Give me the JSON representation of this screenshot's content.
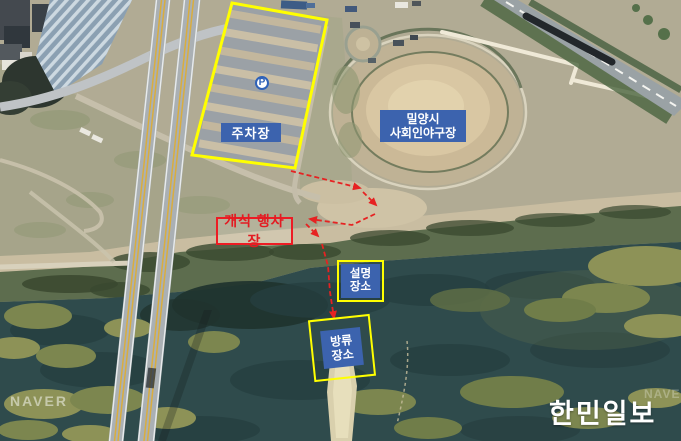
{
  "annotations": {
    "parking": {
      "label": "주차장",
      "icon": "P"
    },
    "stadium": {
      "line1": "밀양시",
      "line2": "사회인야구장"
    },
    "ceremony": {
      "label": "개식 행사장"
    },
    "briefing": {
      "line1": "설명",
      "line2": "장소"
    },
    "release": {
      "line1": "방류",
      "line2": "장소"
    }
  },
  "watermarks": {
    "provider": "NAVER",
    "provider_partial": "NAVER",
    "press": "한민일보"
  },
  "colors": {
    "highlight_yellow": "#ffff00",
    "label_blue": "#3c63ae",
    "alert_red": "#ed1c24",
    "arrow_red": "#e62222"
  }
}
